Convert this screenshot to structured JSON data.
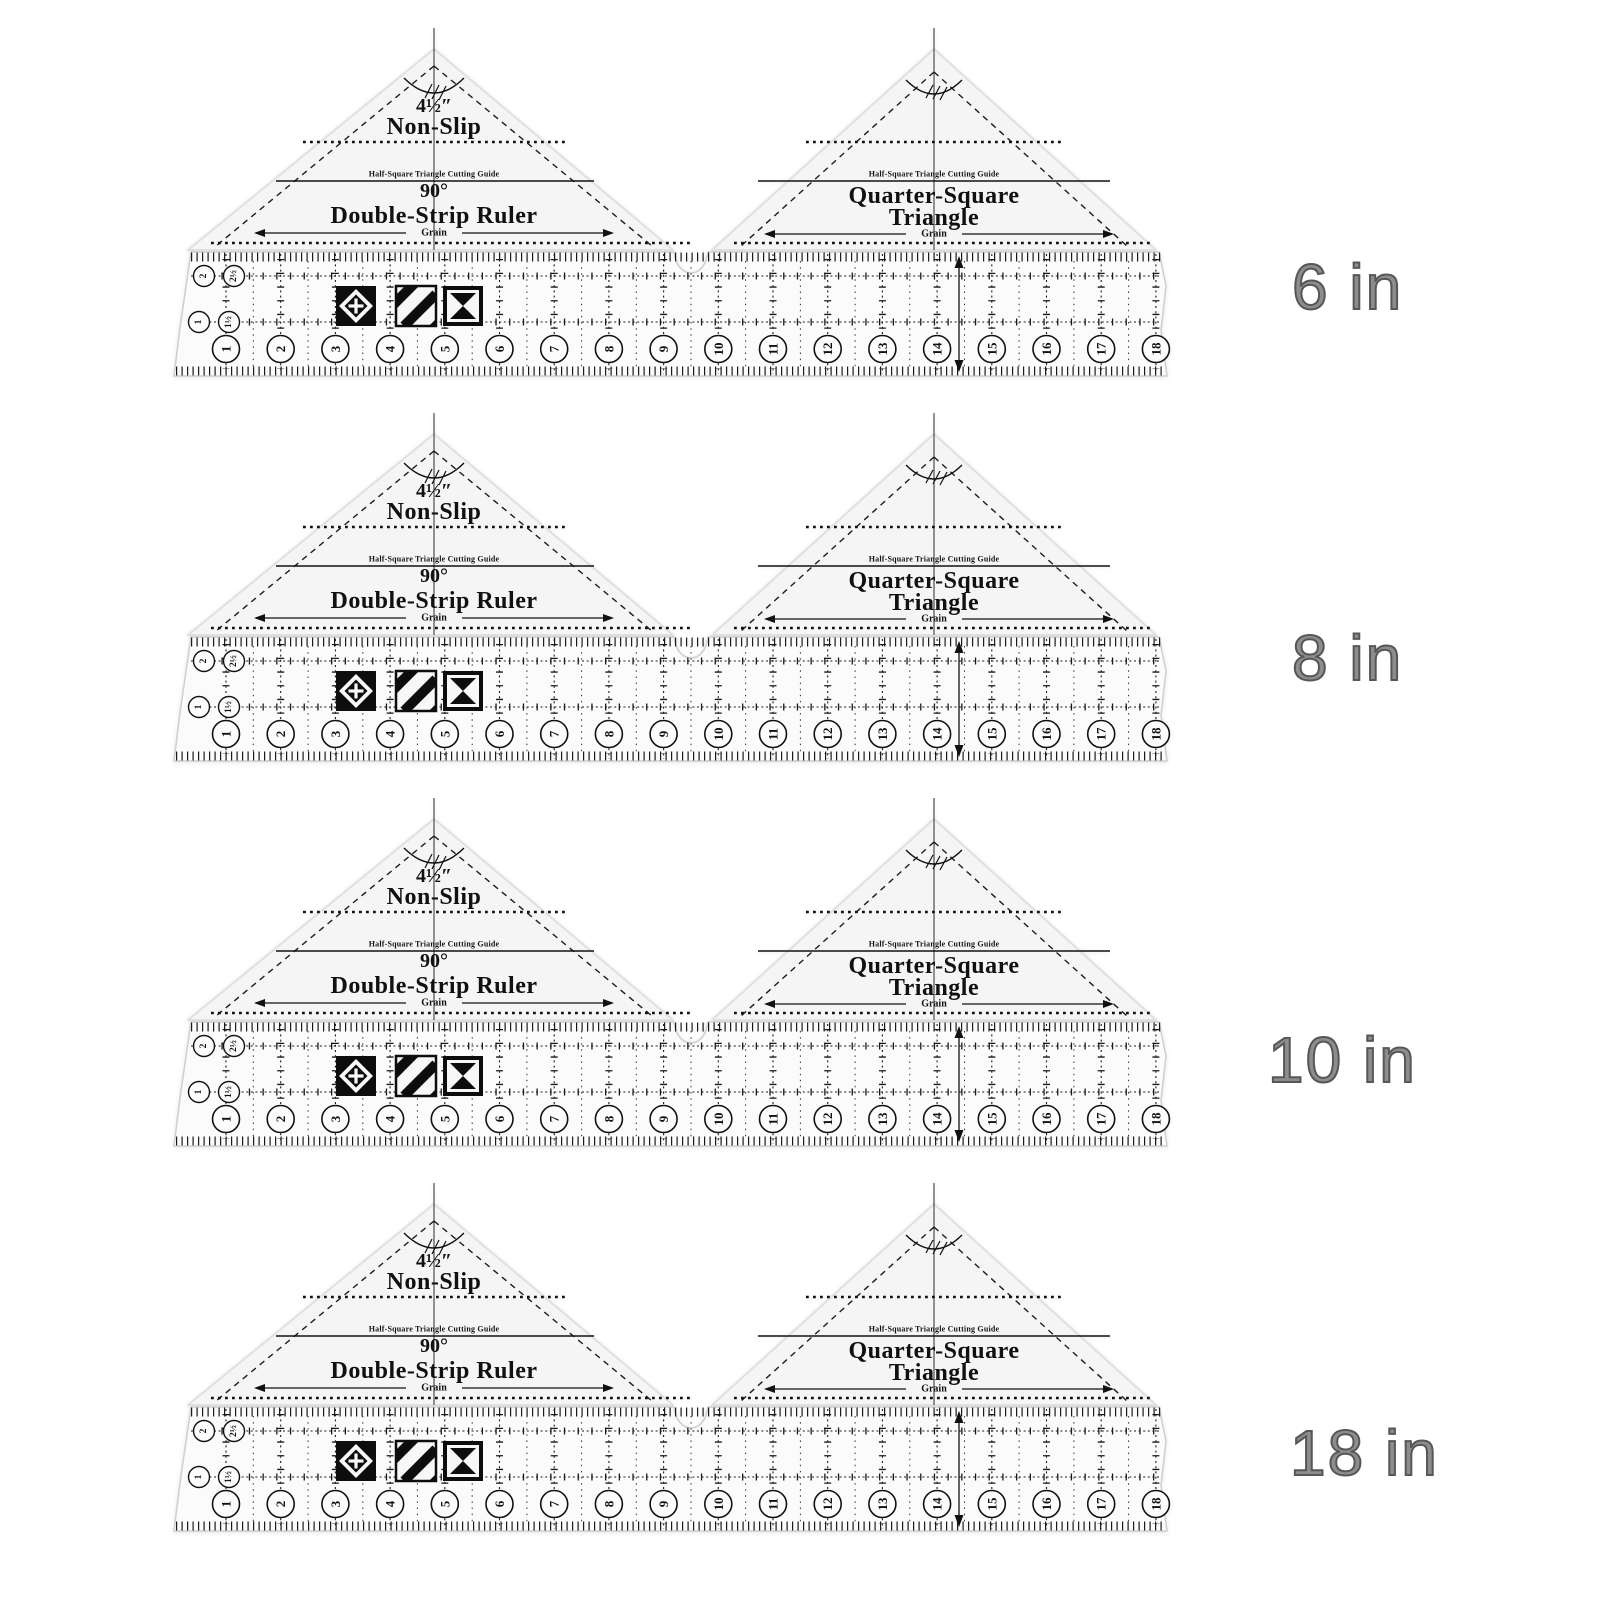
{
  "product": {
    "rows": [
      {
        "size_label": "6 in"
      },
      {
        "size_label": "8 in"
      },
      {
        "size_label": "10 in"
      },
      {
        "size_label": "18 in"
      }
    ]
  },
  "ruler_set": {
    "left_triangle": {
      "size": "4½″",
      "line1": "Non-Slip",
      "cutting_guide": "Half-Square Triangle Cutting Guide",
      "angle": "90°",
      "name": "Double-Strip Ruler",
      "grain": "Grain"
    },
    "right_triangle": {
      "cutting_guide": "Half-Square Triangle Cutting Guide",
      "name_line1": "Quarter-Square",
      "name_line2": "Triangle",
      "grain": "Grain"
    },
    "strip": {
      "scale_numbers": [
        "1",
        "2",
        "3",
        "4",
        "5",
        "6",
        "7",
        "8",
        "9",
        "10",
        "11",
        "12",
        "13",
        "14",
        "15",
        "16",
        "17",
        "18"
      ],
      "strip_width_circles_row1": [
        "2",
        "2½"
      ],
      "strip_width_circles_row2": [
        "1",
        "1½"
      ],
      "block_icons": [
        "square-in-square-block",
        "diagonal-stripes-block",
        "hourglass-block"
      ]
    }
  },
  "colors": {
    "background": "#ffffff",
    "ink": "#111111",
    "plastic": "#f5f5f5",
    "label_text": "#6a6a6a"
  }
}
